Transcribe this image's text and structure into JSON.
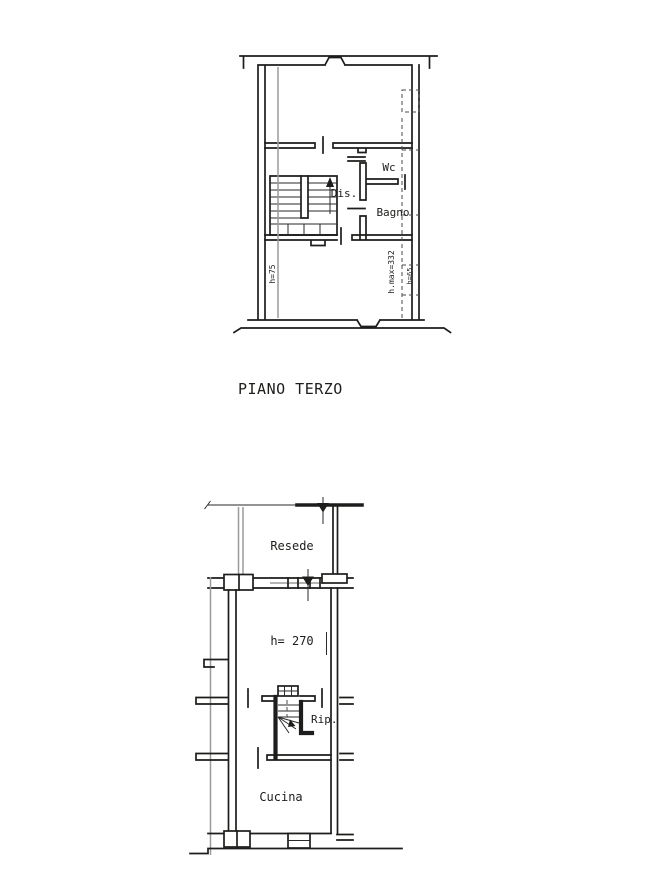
{
  "page": {
    "background": "#ffffff",
    "ink": "#1d1d1b",
    "muted_ink": "#9b9b9b"
  },
  "floor_title": "PIANO TERZO",
  "upper_plan": {
    "rooms": {
      "wc": "Wc",
      "dis": "Dis.",
      "bagno": "Bagno"
    },
    "annotations": {
      "h_left": "h=75",
      "h_max": "h.max=332",
      "h_right": "h=65"
    }
  },
  "lower_plan": {
    "rooms": {
      "resede": "Resede",
      "rip": "Rip.",
      "cucina": "Cucina"
    },
    "annotations": {
      "height": "h= 270"
    }
  }
}
